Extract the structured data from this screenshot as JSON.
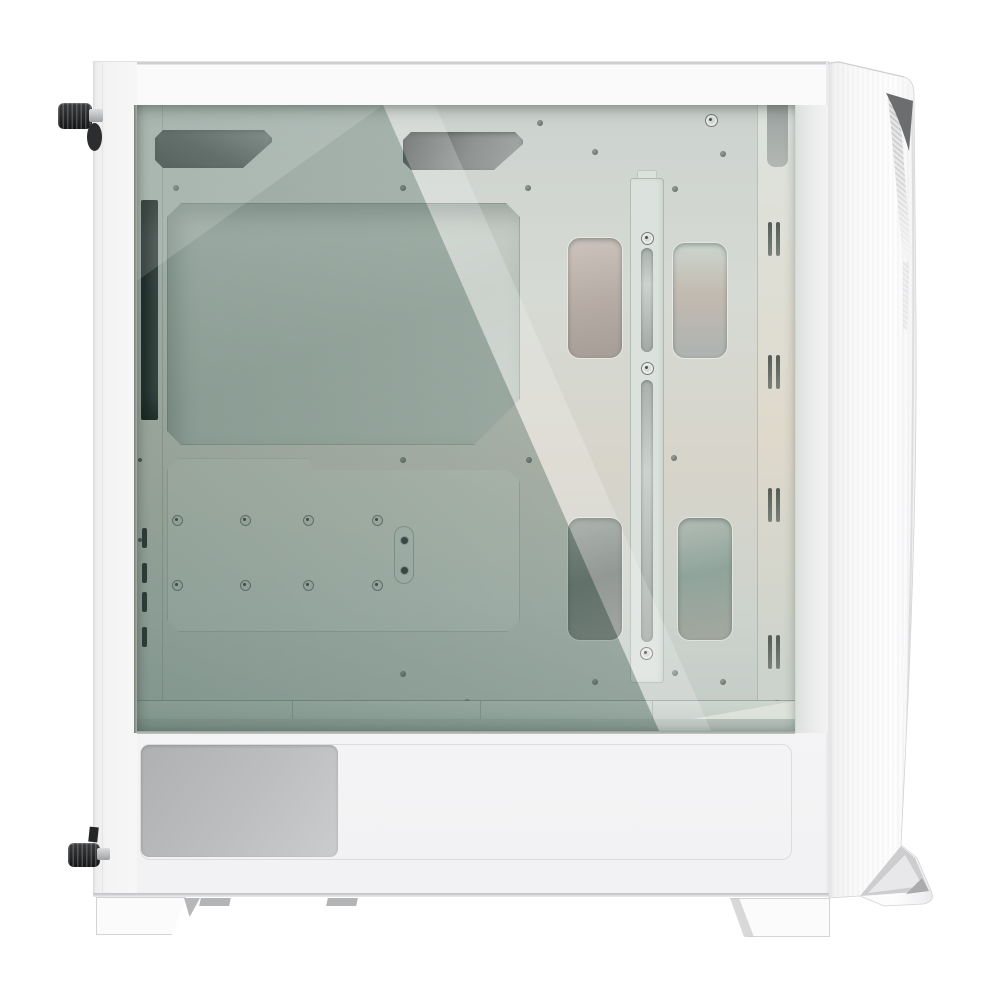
{
  "scene": {
    "type": "product-photo",
    "subject": "White mid-tower PC case with tempered glass side panel, side view on white background",
    "background": "white studio backdrop",
    "visible_text": "none"
  },
  "object": {
    "name": "pc-case",
    "style": "mid-tower ATX chassis",
    "finish": "matte white",
    "parts": [
      "tempered glass side panel",
      "white steel frame and bezels",
      "motherboard tray (cable-management side) with CPU cooler cutout",
      "drive mounting plate with standoff screws",
      "vertical cable-management bar with routing slots",
      "four cable routing cutouts",
      "rear bracket strip (black)",
      "front column ventilation slits",
      "PSU shroud vent grille",
      "front panel with dark mesh intake accent",
      "two black knurled thumbscrews",
      "white case feet with grey pads"
    ]
  },
  "colors": {
    "background": "#ffffff",
    "panel_white": "#f6f6f7",
    "panel_white_bright": "#fafafb",
    "edge_light": "#d8d8da",
    "edge_mid": "#c6c6c8",
    "interior_pale": "#d6dad4",
    "interior_green_dark": "#8da29a",
    "cutout_dark": "#565b59",
    "metal_grey": "#bdbec0",
    "black_part": "#1d1f20",
    "mesh_dark": "#6b6d6f",
    "vent_slit": "#7b817c",
    "screw_black": "#1f2122",
    "hole_grey": "#6e736e",
    "bar_fill": "#dbe1dc",
    "shelf_band": "#ced6d0",
    "psu_band": "#a9b4ae"
  }
}
